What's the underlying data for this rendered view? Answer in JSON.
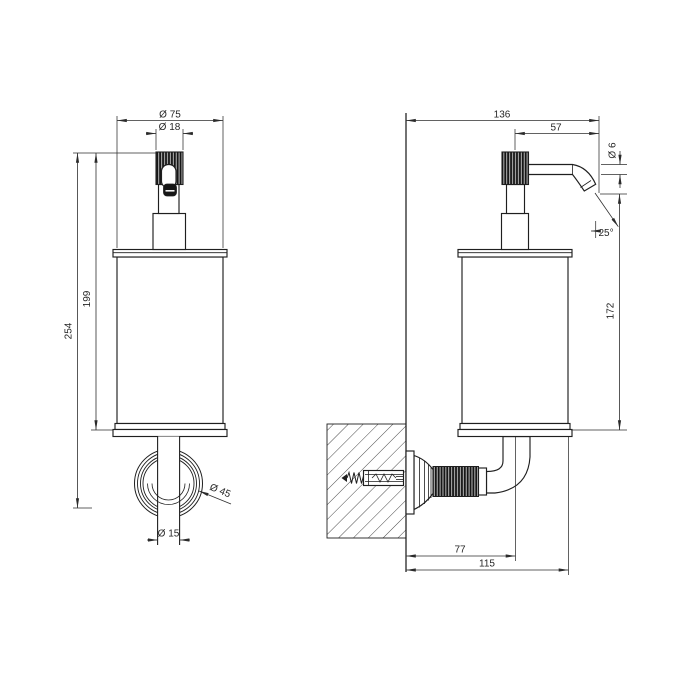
{
  "drawing": {
    "subject": "wall-mounted soap dispenser",
    "views": {
      "front": "front view",
      "side": "side section view"
    }
  },
  "dimensions": {
    "front_view": {
      "body_diameter": "Ø 75",
      "pump_cap_diameter": "Ø 18",
      "total_height": "254",
      "body_height": "199",
      "wall_flange_diameter": "Ø 45",
      "stem_diameter": "Ø 15"
    },
    "side_view": {
      "total_depth": "136",
      "spout_reach": "57",
      "spout_outlet_diameter": "Ø 6",
      "spout_angle": "25°",
      "body_height": "172",
      "bracket_depth": "77",
      "overall_depth": "115"
    }
  },
  "colors": {
    "line": "#1f1f1f",
    "dimension_line": "#2e2e2e",
    "knurl_fill": "#161616",
    "background": "#ffffff"
  }
}
